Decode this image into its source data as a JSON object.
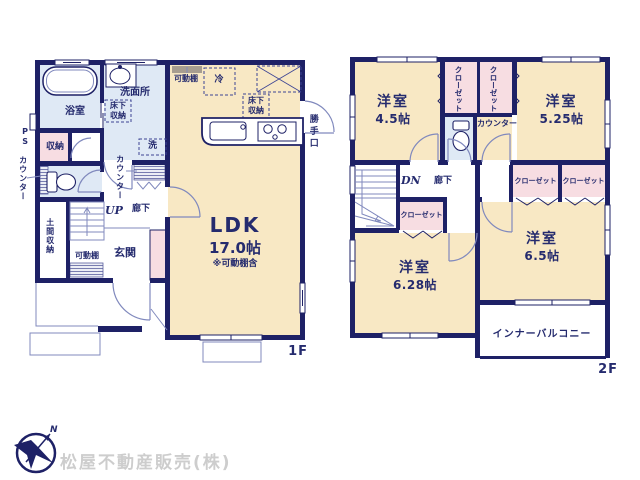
{
  "colors": {
    "wall": "#1e2166",
    "tatami_room": "#f8e8c4",
    "wet_room": "#dfe9f5",
    "closet": "#f7dde2",
    "shelf": "#a79d90",
    "line": "#8089bd",
    "text": "#252b6e",
    "company_text": "#cdcdcd"
  },
  "floor1": {
    "floor_label": "1F",
    "ldk_name": "LDK",
    "ldk_area": "17.0帖",
    "ldk_note": "※可動棚含",
    "bathroom": "浴室",
    "washroom": "洗面所",
    "washroom_underfloor": "床下収納",
    "kitchen_underfloor": "床下収納",
    "storage": "収納",
    "pipe_space": "PS",
    "counter_outside": "カウンター",
    "counter_hall": "カウンター",
    "washer": "洗",
    "fridge": "冷",
    "shelf_kitchen": "可動棚",
    "shelf_entry": "可動棚",
    "doma_storage": "土間収納",
    "entrance": "玄関",
    "hallway": "廊下",
    "stairs_up": "UP",
    "back_door": "勝手口"
  },
  "floor2": {
    "floor_label": "2F",
    "bedroom_a_name": "洋室",
    "bedroom_a_area": "4.5帖",
    "bedroom_b_name": "洋室",
    "bedroom_b_area": "5.25帖",
    "bedroom_c_name": "洋室",
    "bedroom_c_area": "6.28帖",
    "bedroom_d_name": "洋室",
    "bedroom_d_area": "6.5帖",
    "closet_a": "クローゼット",
    "closet_b": "クローゼット",
    "closet_c": "クローゼット",
    "closet_d": "クローゼット",
    "closet_e": "クローゼット",
    "counter": "カウンター",
    "hallway": "廊下",
    "stairs_down": "DN",
    "balcony": "インナーバルコニー"
  },
  "footer": {
    "company": "松屋不動産販売(株)",
    "compass_north": "N"
  }
}
